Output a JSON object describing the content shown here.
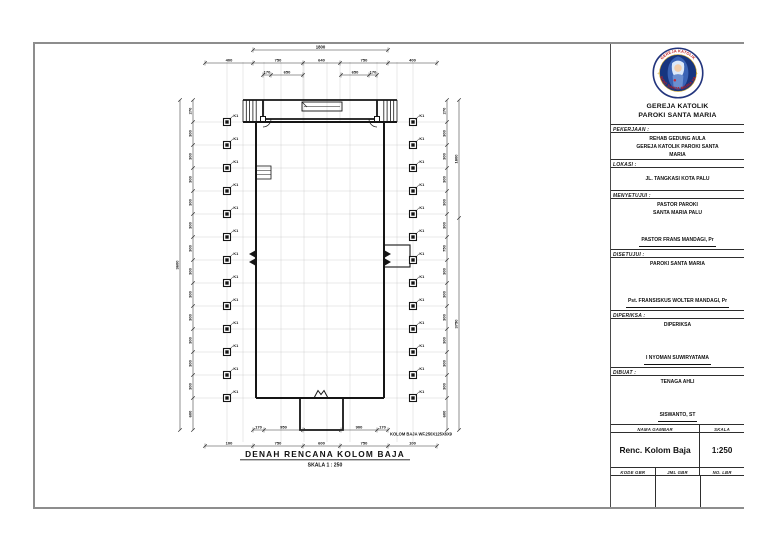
{
  "sheet": {
    "drawing": {
      "title": "DENAH RENCANA KOLOM BAJA",
      "scale_label": "SKALA 1 : 250",
      "note": "KOLOM BAJA  WF.250X125X6X9",
      "column_label": "K1",
      "dims": {
        "top_overall": "1800",
        "top_row": [
          "400",
          "750",
          "640",
          "750",
          "400"
        ],
        "top_inner_left": [
          "170",
          "650"
        ],
        "top_inner_right": [
          "650",
          "170"
        ],
        "bottom_inner_left": [
          "170",
          "950"
        ],
        "bottom_inner_right": [
          "900",
          "170"
        ],
        "bottom_row": [
          "100",
          "750",
          "600",
          "750",
          "100"
        ],
        "left_chain": [
          "270",
          "300",
          "300",
          "300",
          "300",
          "300",
          "300",
          "300",
          "300",
          "300",
          "300",
          "300",
          "300",
          "600"
        ],
        "left_overall": "3600",
        "right_chain": [
          "270",
          "300",
          "300",
          "300",
          "300",
          "300",
          "750",
          "300",
          "300",
          "300",
          "300",
          "300",
          "300",
          "600"
        ],
        "right_upper": "1800",
        "right_overall": "3750"
      }
    },
    "title_block": {
      "logo": {
        "arc_top": "GEREJA KATOLIK",
        "arc_bottom": "PAROKI SANTA MARIA PALU"
      },
      "org": [
        "GEREJA KATOLIK",
        "PAROKI SANTA MARIA"
      ],
      "sections": [
        {
          "label": "PEKERJAAN :",
          "lines": [
            "REHAB GEDUNG AULA",
            "GEREJA KATOLIK PAROKI SANTA",
            "MARIA"
          ],
          "signature": ""
        },
        {
          "label": "LOKASI :",
          "lines": [
            "JL. TANGKASI KOTA PALU"
          ],
          "signature": ""
        },
        {
          "label": "MENYETUJUI :",
          "lines": [
            "PASTOR PAROKI",
            "SANTA MARIA PALU"
          ],
          "signature": "PASTOR FRANS MANDAGI, Pr"
        },
        {
          "label": "DISETUJUI :",
          "lines": [
            "PAROKI SANTA MARIA"
          ],
          "signature": "Pst. FRANSISKUS WOLTER MANDAGI, Pr"
        },
        {
          "label": "DIPERIKSA :",
          "lines": [
            "DIPERIKSA"
          ],
          "signature": "I NYOMAN SUWIRYATAMA"
        },
        {
          "label": "DIBUAT :",
          "lines": [
            "TENAGA AHLI"
          ],
          "signature": "SISWANTO, ST"
        }
      ],
      "footer": {
        "name_label": "NAMA GAMBAR",
        "scale_label": "SKALA",
        "drawing_name": "Renc. Kolom Baja",
        "scale_value": "1:250",
        "code_label": "KODE GBR",
        "count_label": "JML GBR",
        "sheet_label": "NO. LBR"
      }
    }
  }
}
